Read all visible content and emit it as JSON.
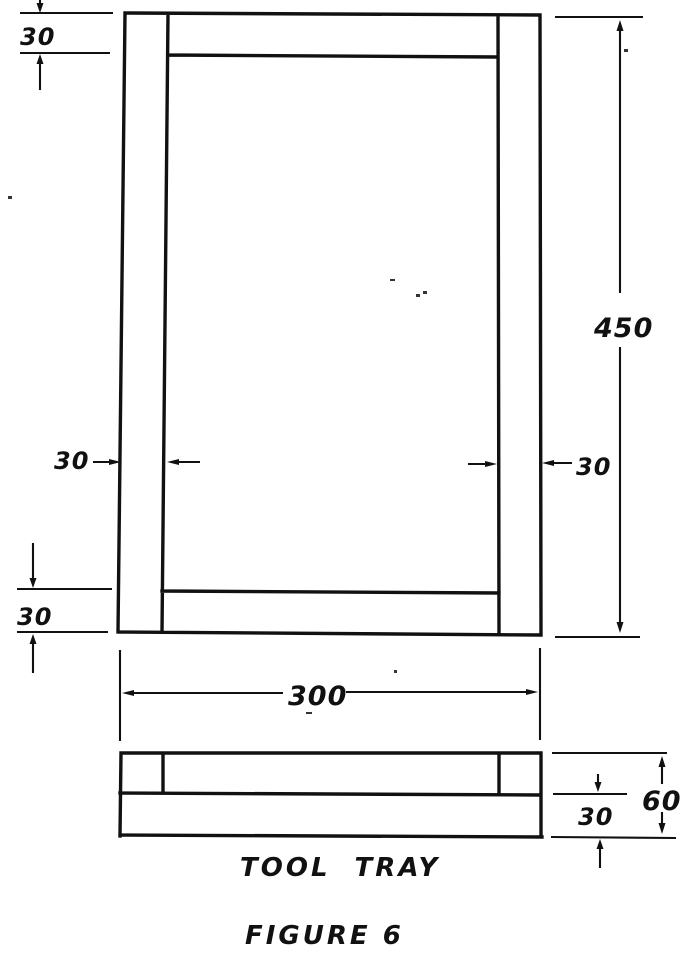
{
  "figure": {
    "title": "TOOL TRAY",
    "caption": "FIGURE 6"
  },
  "ink_color": "#111111",
  "plan_view": {
    "top_rail": "30",
    "left_rail": "30",
    "right_rail": "30",
    "bottom_rail": "30",
    "overall_length": "450",
    "overall_width": "300"
  },
  "side_view": {
    "base_thickness": "30",
    "overall_height": "60"
  }
}
